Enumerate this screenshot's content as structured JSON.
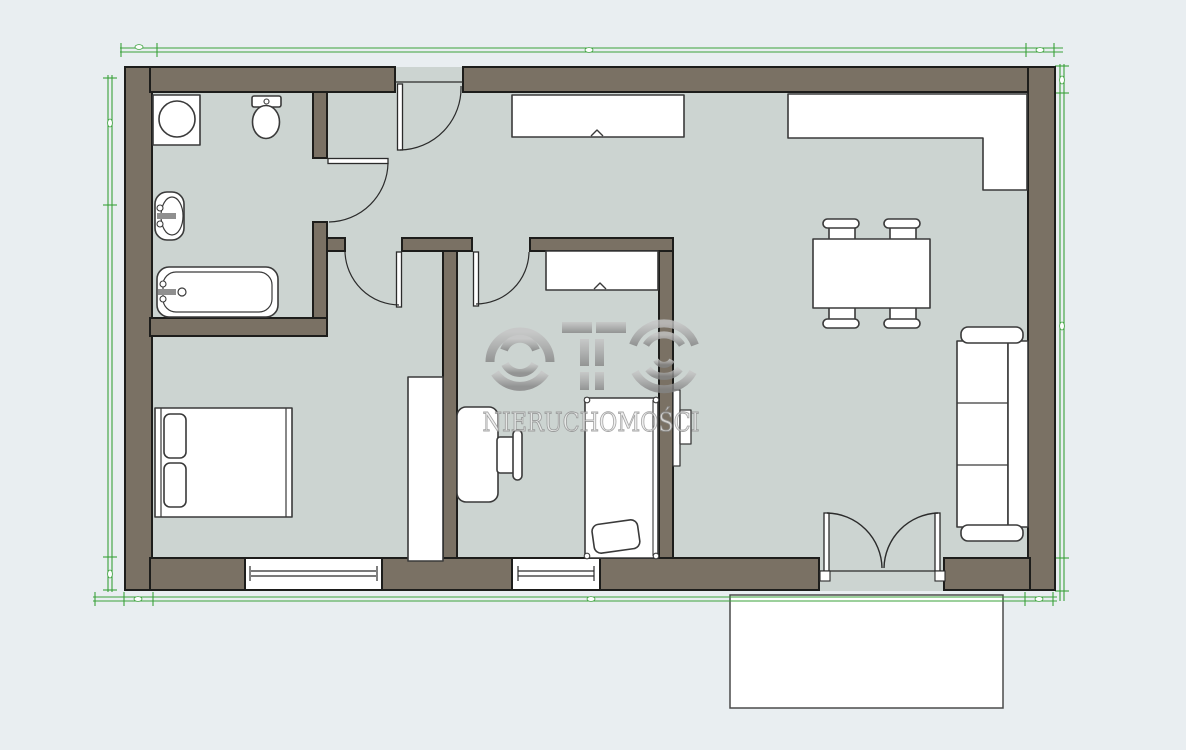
{
  "watermark": {
    "brand": "OTO",
    "subtitle": "NIERUCHOMOŚCI"
  },
  "colors": {
    "background": "#e9eef1",
    "floor": "#ccd4d1",
    "wall_fill": "#7a7164",
    "wall_outline": "#1d1d1b",
    "furniture_fill": "#ffffff",
    "furniture_stroke": "#3a3a3a",
    "door_line": "#2b2b2b",
    "dimension_green": "#3aa13a",
    "watermark_gray": "#9c9c9c",
    "terrace_border": "#4a4a4a"
  },
  "plan": {
    "type": "apartment-floor-plan",
    "rooms": [
      {
        "name": "bathroom",
        "fixtures": [
          "washing-machine",
          "toilet",
          "washbasin",
          "bathtub",
          "bathroom-door"
        ]
      },
      {
        "name": "hallway",
        "fixtures": [
          "entrance-door",
          "hallway-closet"
        ]
      },
      {
        "name": "bedroom-1",
        "fixtures": [
          "double-bed",
          "pillows",
          "wardrobe",
          "window",
          "bedroom1-door"
        ]
      },
      {
        "name": "bedroom-2",
        "fixtures": [
          "single-bed",
          "pillow",
          "desk",
          "desk-chair",
          "closet",
          "window",
          "bedroom2-door"
        ]
      },
      {
        "name": "living-room-with-kitchen",
        "fixtures": [
          "kitchen-counter-l-shape",
          "dining-table",
          "dining-chair",
          "dining-chair",
          "dining-chair",
          "dining-chair",
          "sofa",
          "tv",
          "french-doors"
        ]
      },
      {
        "name": "terrace",
        "fixtures": []
      }
    ],
    "windows_count": 2,
    "doors_count": 5
  }
}
